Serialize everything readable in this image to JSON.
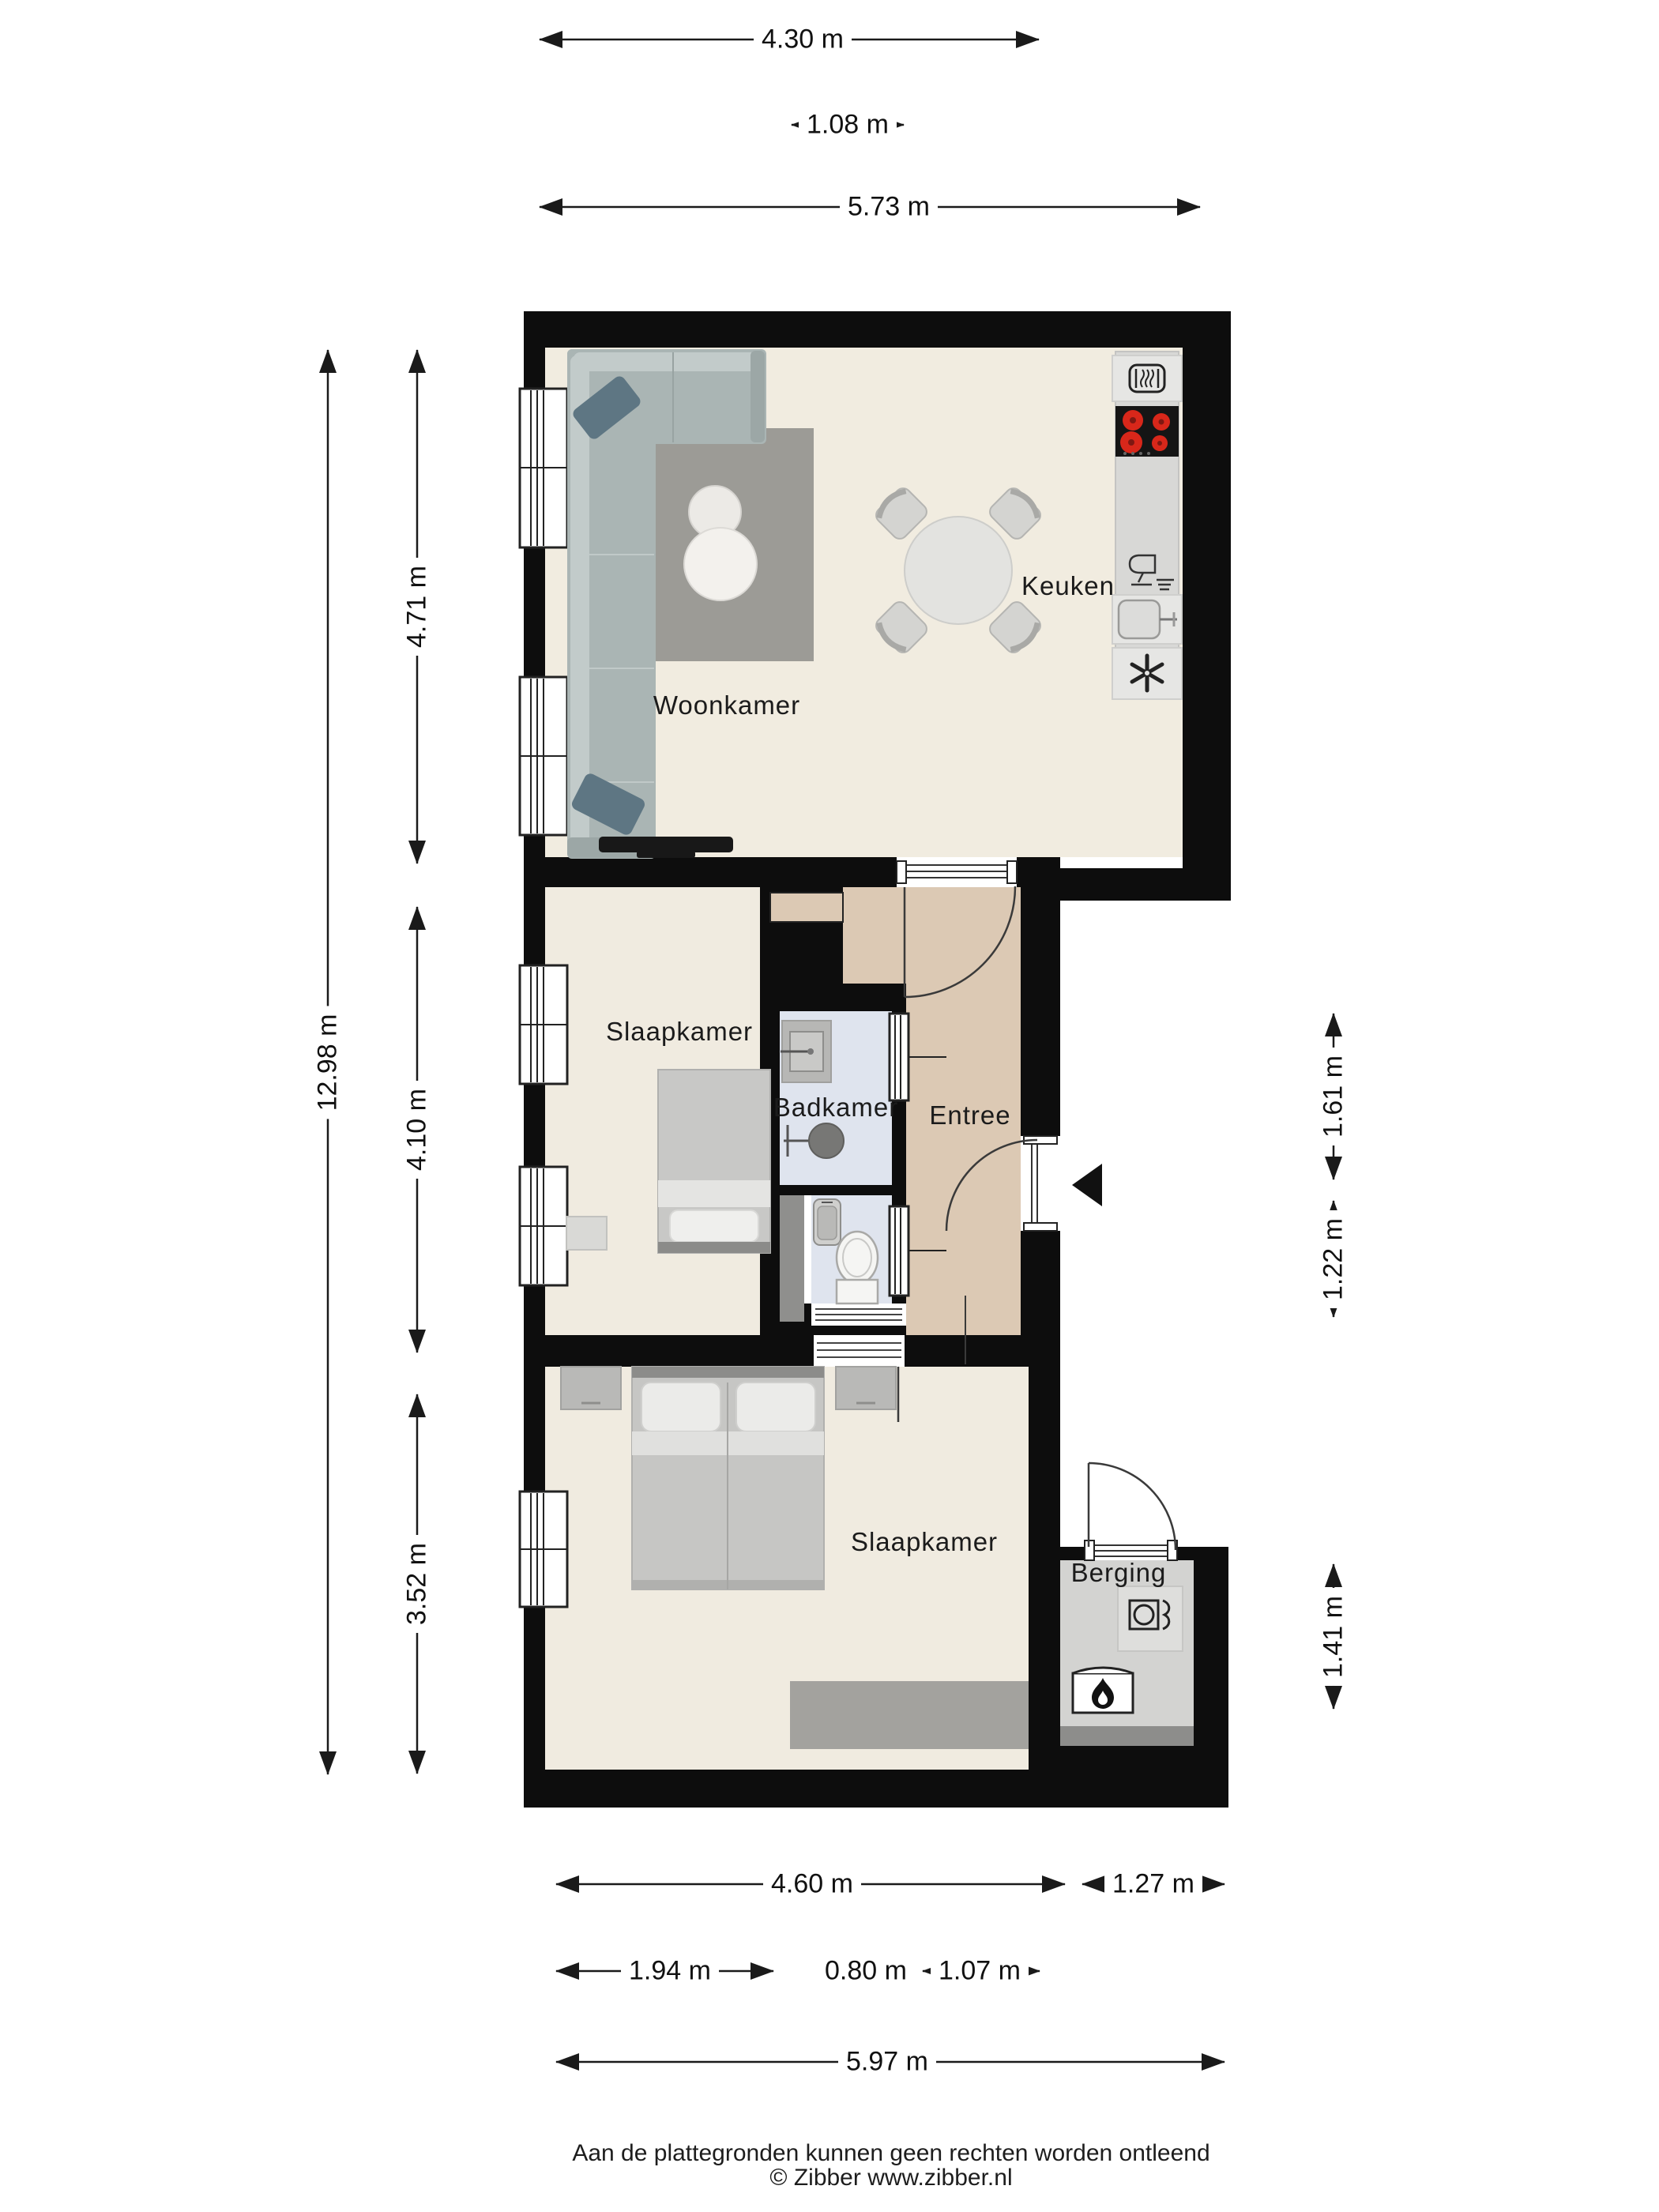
{
  "document": {
    "type": "floorplan",
    "language": "nl",
    "background": "#ffffff"
  },
  "rooms": [
    {
      "id": "woonkamer",
      "label": "Woonkamer"
    },
    {
      "id": "keuken",
      "label": "Keuken"
    },
    {
      "id": "slaapkamer-1",
      "label": "Slaapkamer"
    },
    {
      "id": "badkamer",
      "label": "Badkamer"
    },
    {
      "id": "entree",
      "label": "Entree"
    },
    {
      "id": "slaapkamer-2",
      "label": "Slaapkamer"
    },
    {
      "id": "berging",
      "label": "Berging"
    }
  ],
  "dimensions": {
    "top": [
      {
        "label": "4.30 m"
      },
      {
        "label": "1.08 m"
      },
      {
        "label": "5.73 m"
      }
    ],
    "left": [
      {
        "label": "12.98 m"
      },
      {
        "label": "4.71 m"
      },
      {
        "label": "4.10 m"
      },
      {
        "label": "3.52 m"
      }
    ],
    "right": [
      {
        "label": "1.61 m"
      },
      {
        "label": "1.22 m"
      },
      {
        "label": "1.41 m"
      }
    ],
    "bottom": [
      {
        "label": "4.60 m"
      },
      {
        "label": "1.27 m"
      },
      {
        "label": "1.94 m"
      },
      {
        "label": "0.80 m"
      },
      {
        "label": "1.07 m"
      },
      {
        "label": "5.97 m"
      }
    ]
  },
  "footer": {
    "line1": "Aan de plattegronden kunnen geen rechten worden ontleend",
    "line2": "© Zibber www.zibber.nl"
  },
  "icons": [
    "oven-icon",
    "stove-icon",
    "dishwasher-icon",
    "kitchen-sink-icon",
    "extractor-fan-icon",
    "bathroom-sink-icon",
    "shower-icon",
    "toilet-icon",
    "wc-sink-icon",
    "washing-machine-icon",
    "boiler-flame-icon",
    "entrance-marker-icon"
  ],
  "colors": {
    "wall": "#0d0d0d",
    "floor_living": "#f1ece0",
    "floor_entree": "#dcc9b4",
    "floor_bath": "#dfe4ee",
    "floor_berging": "#d3d3d1",
    "counter": "#d8d8d6",
    "appliance": "#e6e6e4",
    "stove": "#151515",
    "burner": "#d8271a",
    "sofa": "#aab5b4",
    "cushion": "#5e7683",
    "rug": "#9c9b96",
    "bed": "#c6c6c4",
    "dim_line": "#1a1a1a"
  }
}
